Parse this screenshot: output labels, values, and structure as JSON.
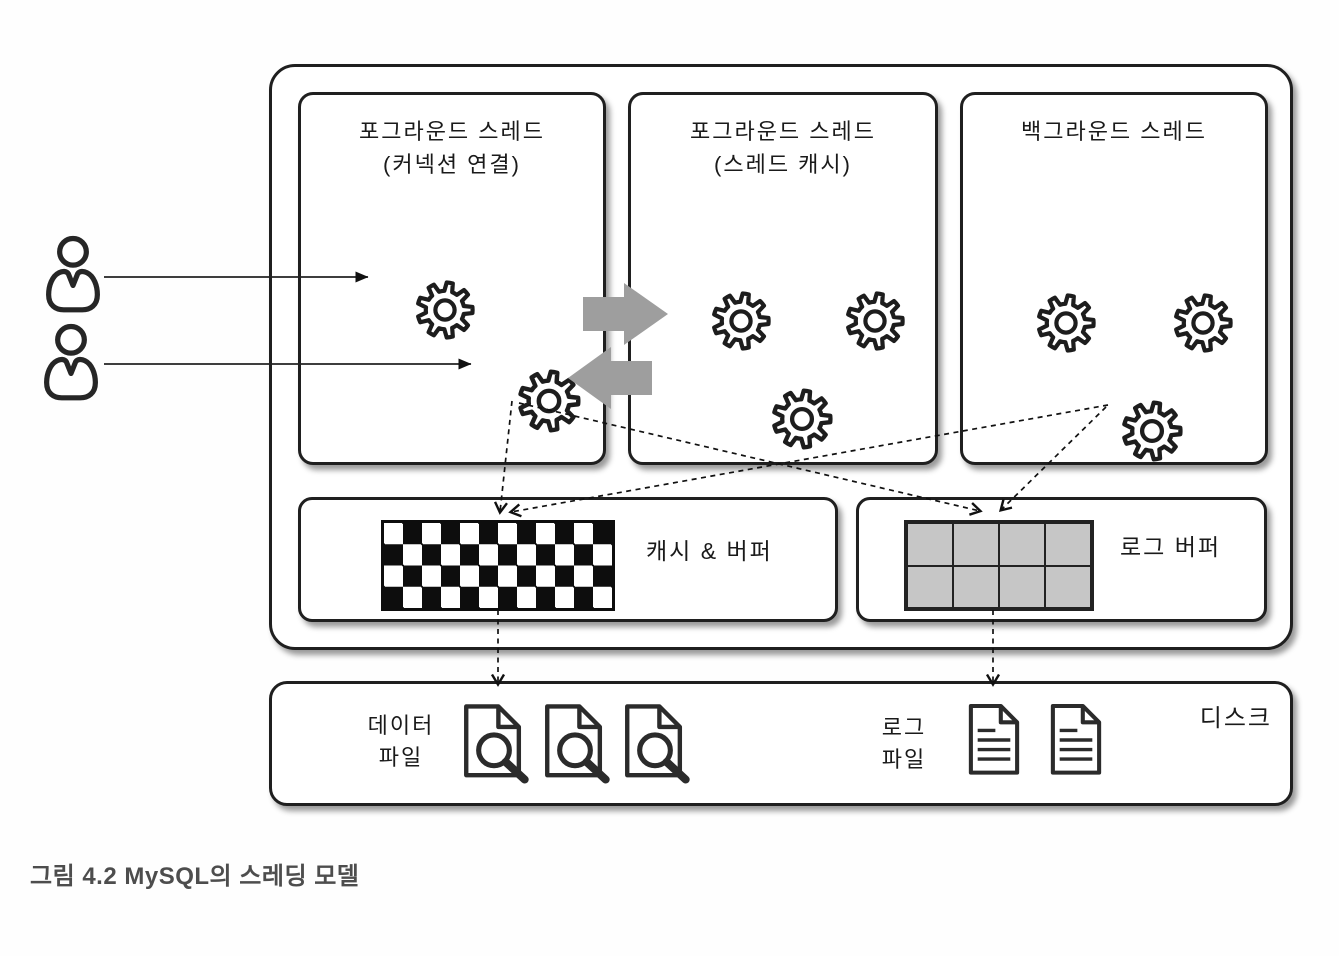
{
  "figure": {
    "caption": "그림 4.2 MySQL의 스레딩 모델",
    "server": {
      "thread_boxes": [
        {
          "title": "포그라운드 스레드",
          "subtitle": "(커넥션 연결)",
          "gears": 2
        },
        {
          "title": "포그라운드 스레드",
          "subtitle": "(스레드 캐시)",
          "gears": 3
        },
        {
          "title": "백그라운드 스레드",
          "subtitle": "",
          "gears": 3
        }
      ],
      "cache_buffer_label": "캐시 & 버퍼",
      "log_buffer_label": "로그 버퍼"
    },
    "disk": {
      "label": "디스크",
      "data_files": {
        "line1": "데이터",
        "line2": "파일",
        "count": 3
      },
      "log_files": {
        "line1": "로그",
        "line2": "파일",
        "count": 2
      }
    },
    "clients": {
      "count": 2
    },
    "colors": {
      "line": "#1c1c1c",
      "block_arrow": "#9e9e9e",
      "log_grid_fill": "#c6c6c6"
    }
  }
}
